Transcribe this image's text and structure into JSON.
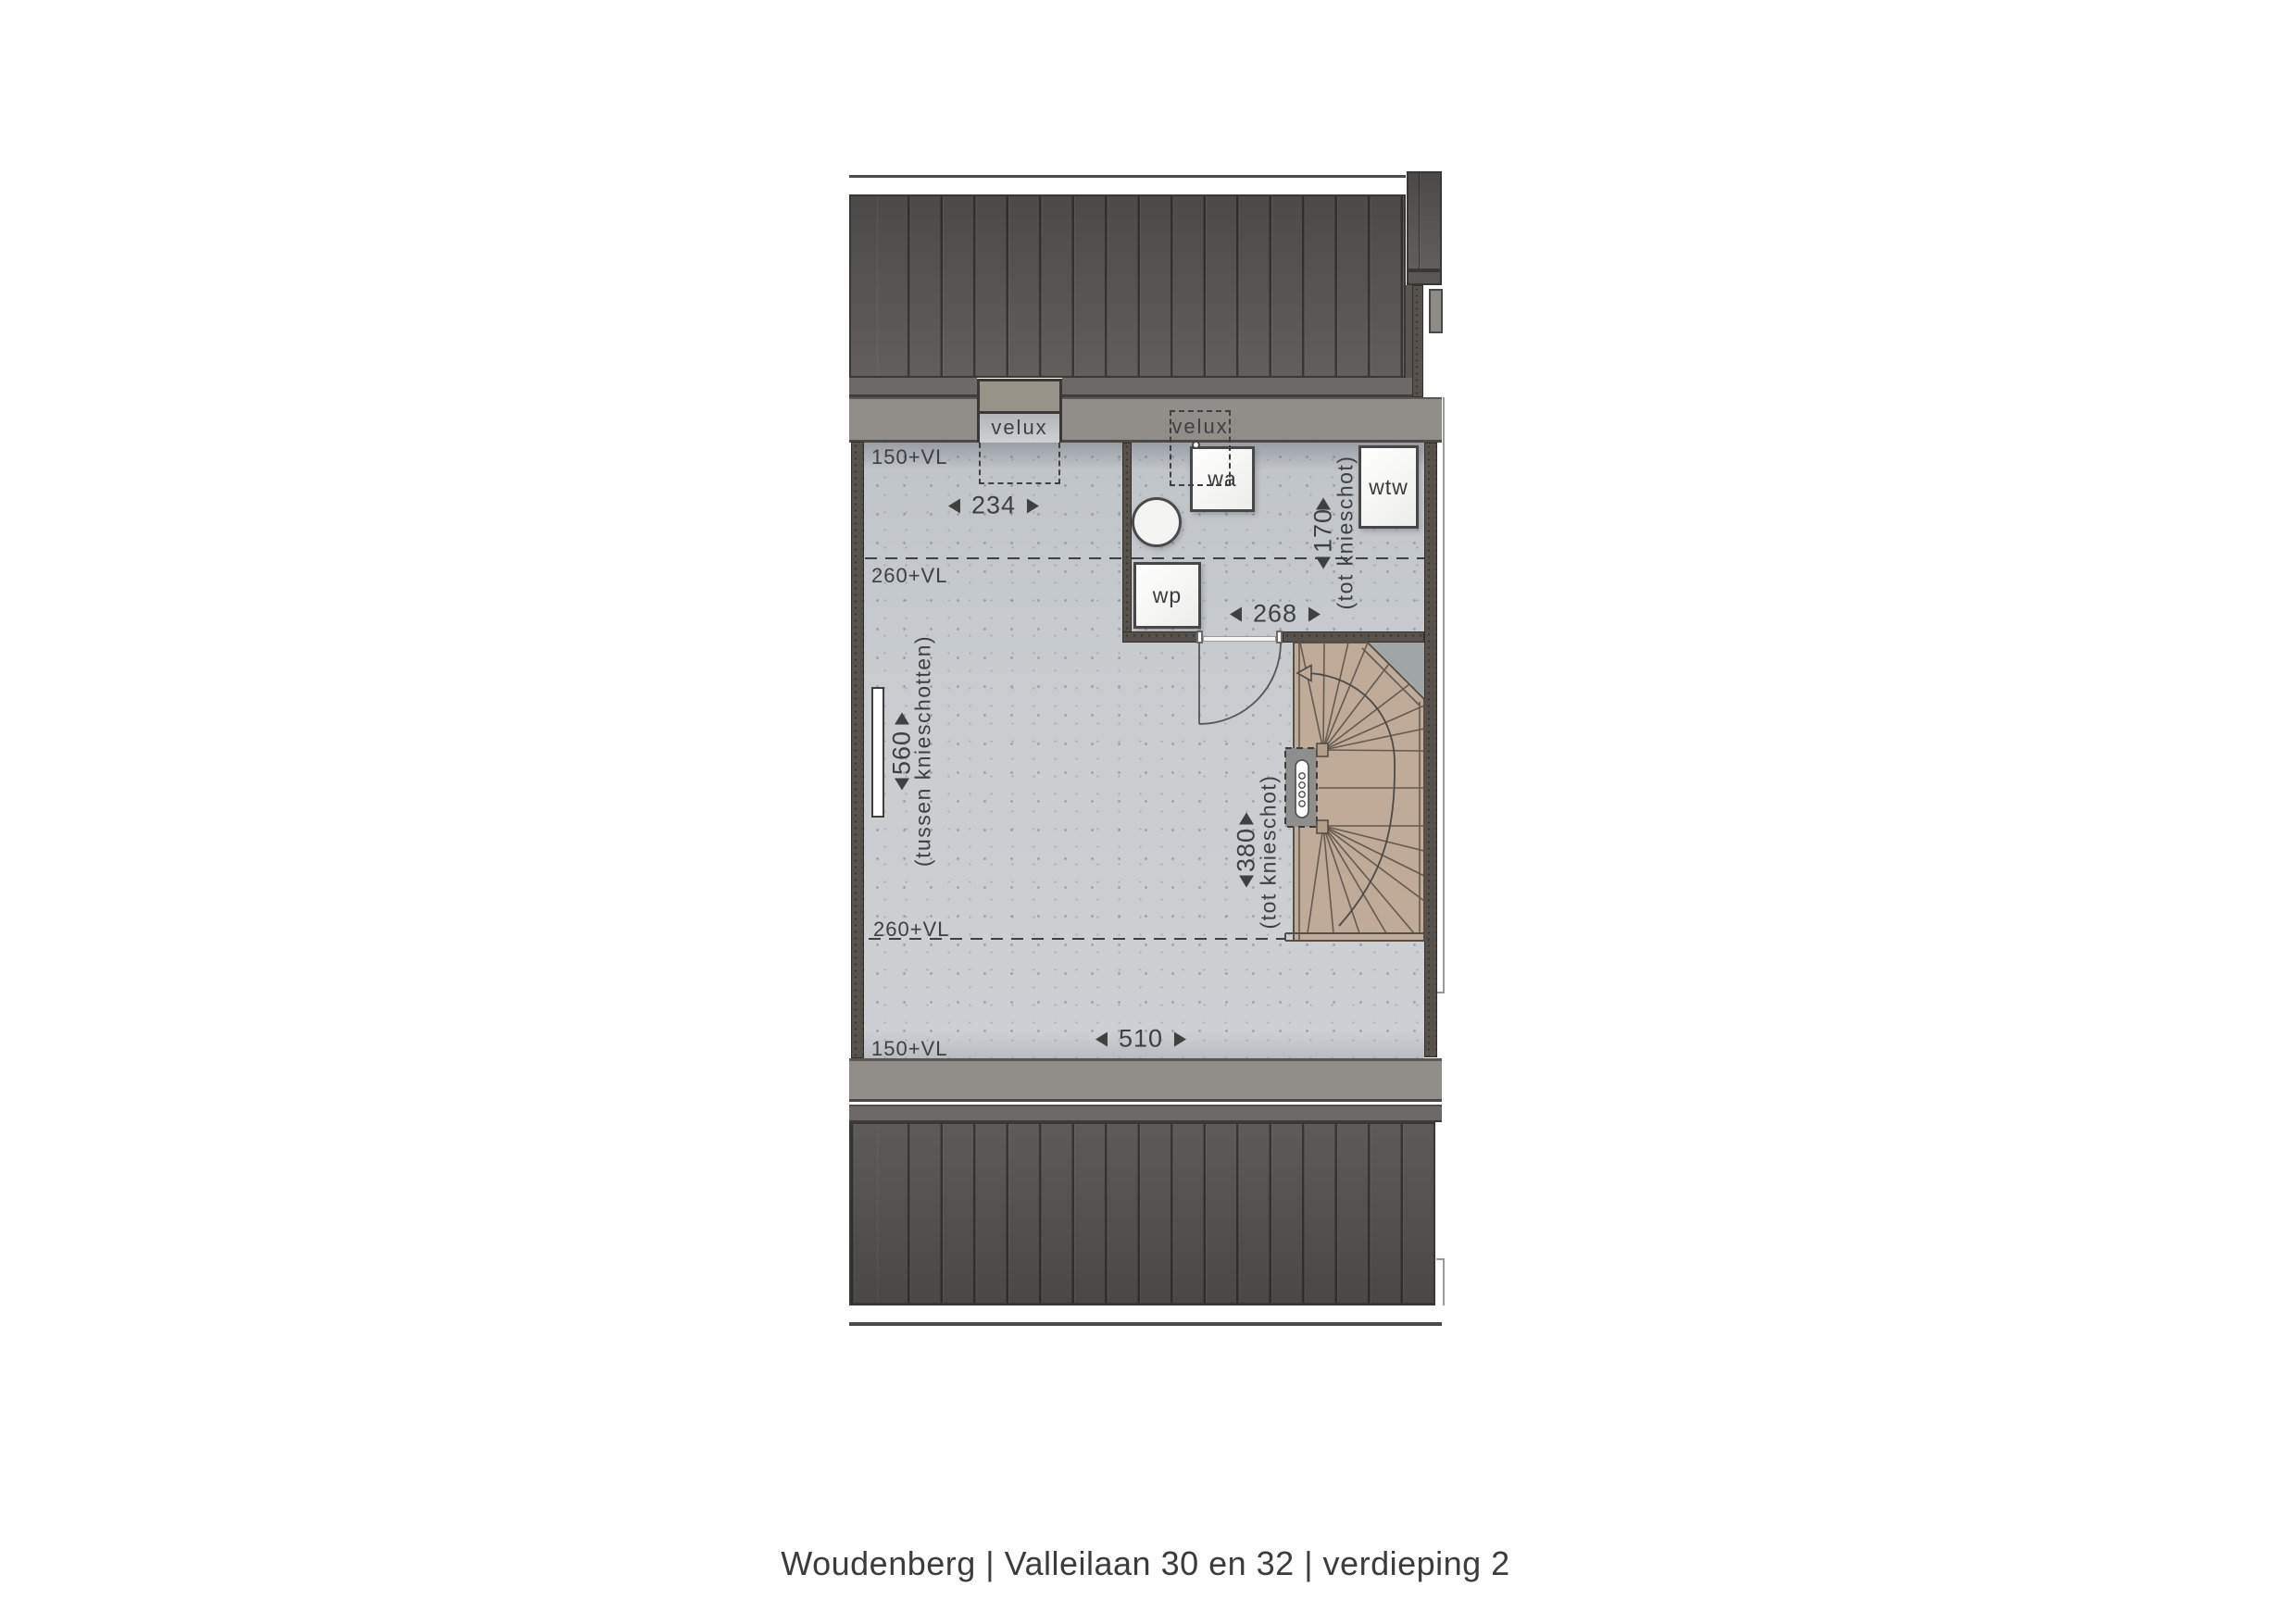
{
  "caption": "Woudenberg | Valleilaan 30 en 32 | verdieping 2",
  "plan": {
    "dormer_left_label": "velux",
    "dormer_right_label": "velux",
    "levels": {
      "vl150_top": "150+VL",
      "vl260_top": "260+VL",
      "vl260_bottom": "260+VL",
      "vl150_bottom": "150+VL"
    },
    "fixtures": {
      "wa": "wa",
      "wp": "wp",
      "wtw": "wtw"
    },
    "dimensions": {
      "dormer_width": {
        "value": "234"
      },
      "landing_width": {
        "value": "268"
      },
      "room_width": {
        "value": "510"
      },
      "room_depth": {
        "value": "560",
        "note": "(tussen knieschotten)"
      },
      "tech_depth": {
        "value": "170",
        "note": "(tot knieschot)"
      },
      "stair_depth": {
        "value": "380",
        "note": "(tot knieschot)"
      }
    }
  },
  "colors": {
    "roof": "#4e4c49",
    "gutter_band": "#918e8a",
    "floor": "#c6cacd",
    "wall": "#58524c",
    "stair_wood": "#bfab97",
    "ink": "#3f4040"
  }
}
